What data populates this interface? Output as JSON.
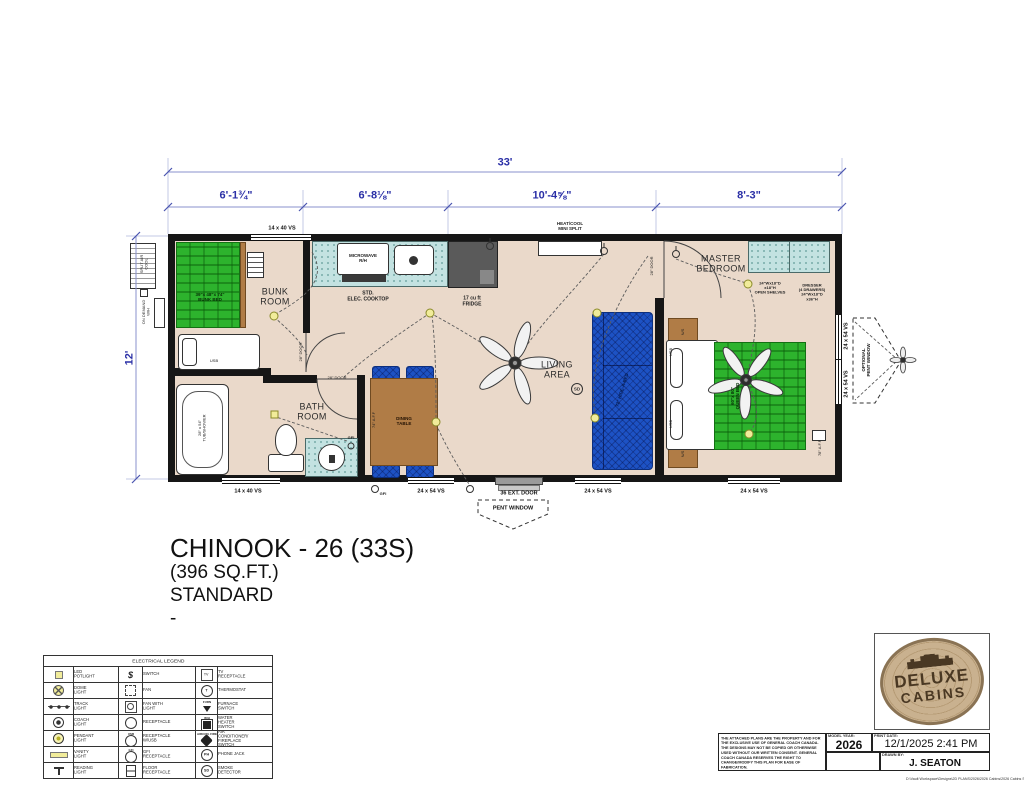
{
  "colors": {
    "wall": "#161616",
    "floor": "#ead9ca",
    "dim_blue": "#2a2fa6",
    "mattress_green": "#2db32d",
    "counter_teal": "#c3e2e1",
    "sofa_blue": "#1d52c4",
    "wood_brown": "#b07c46",
    "light_yellow": "#f1ec9a",
    "brand_blue": "#1d3f8f",
    "brand_red": "#c0272d",
    "logo_tan": "#c9b18f",
    "logo_brown": "#4a3823"
  },
  "dims": {
    "overall": "33'",
    "seg1": "6'-1¾\"",
    "seg2": "6'-8⅛\"",
    "seg3": "10'-4⅝\"",
    "seg4": "8'-3\"",
    "height": "12'"
  },
  "rooms": {
    "bunk": "BUNK\nROOM",
    "bath": "BATH\nROOM",
    "living": "LIVING\nAREA",
    "master": "MASTER\nBEDROOM"
  },
  "fixtures": {
    "bunk_bed": "39\"x 48\"x 74\"\nBUNK BED",
    "queen_bed": "60\"x 80\"\nQUEEN BED",
    "sofa": "72\" HIDE-A-BED",
    "tub": "28\" x 54\"\nTUB/SHOWER",
    "microwave": "MICROWAVE\nR/H",
    "cooktop": "STD.\nELEC. COOKTOP",
    "fridge": "17 cu ft\nFRIDGE",
    "dining": "DINING\nTABLE",
    "minisplit": "HEAT/COOL\nMINI SPLIT",
    "split_air": "SPLIT AIR\nCOOL",
    "ondemand": "ON DEMAND\nW/H",
    "open_shelves": "24\"Wx18\"D\nx18\"H\nOPEN SHELVES",
    "dresser": "DRESSER\n(4 DRAWERS)\n24\"Wx18\"D\nx36\"H",
    "ns": "N/S",
    "usb": "USB",
    "gfi": "GFI",
    "sd": "SD",
    "aff74": "74\" A.F.F",
    "aff78": "78\" A.F.F",
    "door28": "28\" DOOR"
  },
  "windows": {
    "top": "14 x 40 VS",
    "b1": "14 x 40 VS",
    "b2": "24 x 54 VS",
    "door": "36 EXT. DOOR",
    "b3": "24 x 54 VS",
    "b4": "24 x 54 VS",
    "r1": "24 x 54 VS",
    "r2": "24 x 54 VS",
    "pent": "PENT WINDOW",
    "opt_pent": "OPTIONAL\nPENT WINDOW"
  },
  "title": {
    "name": "CHINOOK - 26 (33S)",
    "sqft": "(396 SQ.FT.)",
    "trim": "STANDARD",
    "dash": "-"
  },
  "legend": {
    "title": "ELECTRICAL LEGEND",
    "sym": {
      "switch": "$",
      "tv": "TV",
      "thermo": "T",
      "furn": "FURN",
      "wh": "W/H",
      "usb": "USB",
      "gfi": "GFI",
      "ph": "PH",
      "sd": "SD",
      "acfp": "AIRCON. FIRE"
    },
    "rows": [
      {
        "l1": "LED POTLIGHT",
        "l2": "SWITCH",
        "l3": "TV RECEPTACLE"
      },
      {
        "l1": "DOME LIGHT",
        "l2": "FAN",
        "l3": "THERMOSTAT"
      },
      {
        "l1": "TRACK LIGHT",
        "l2": "FAN WITH LIGHT",
        "l3": "FURNACE SWITCH"
      },
      {
        "l1": "COACH LIGHT",
        "l2": "RECEPTACLE",
        "l3": "WATER HEATER SWITCH"
      },
      {
        "l1": "PENDANT LIGHT",
        "l2": "RECEPTACLE W/USB",
        "l3": "AIR CONDITIONER/ FIREPLACE SWITCH"
      },
      {
        "l1": "VANITY LIGHT",
        "l2": "GFI RECEPTACLE",
        "l3": "PHONE JACK"
      },
      {
        "l1": "READING LIGHT",
        "l2": "FLOOR RECEPTACLE",
        "l3": "SMOKE DETECTOR"
      }
    ]
  },
  "block": {
    "disclaimer": "THE ATTACHED PLANS ARE THE PROPERTY AND FOR THE EXCLUSIVE USE OF GENERAL COACH CANADA. THE DESIGNS MAY NOT BE COPIED OR OTHERWISE USED WITHOUT OUR WRITTEN CONSENT. GENERAL COACH CANADA RESERVES THE RIGHT TO CHANGE/MODIFY THIS PLAN FOR EASE OF FABRICATION.",
    "model_year_label": "MODEL YEAR:",
    "model_year": "2026",
    "print_date_label": "PRINT DATE:",
    "print_date": "12/1/2025 2:41 PM",
    "drawn_by_label": "DRAWN BY:",
    "drawn_by": "J. SEATON",
    "brand": "GENERAL COACH",
    "brand_sub": "CABINS",
    "path": "D:\\Vault Workspace\\Designs\\2D PLANS\\2026\\2026 Cabins\\2026 Cabins Standard"
  },
  "logo": {
    "line1": "DELUXE",
    "line2": "CABINS"
  }
}
